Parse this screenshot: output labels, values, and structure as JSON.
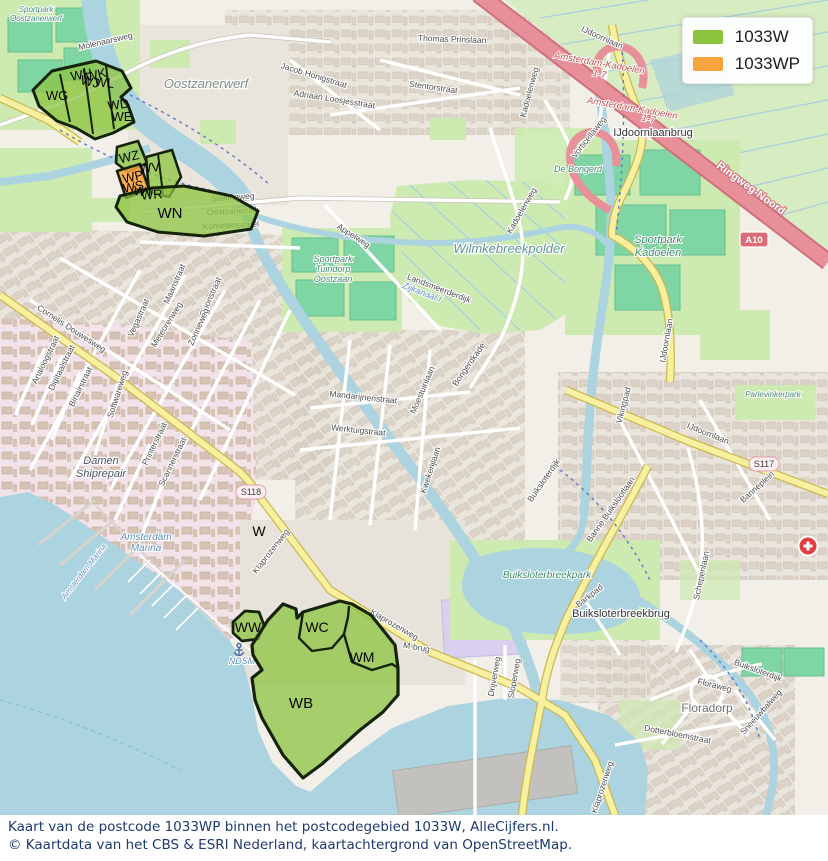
{
  "legend": {
    "items": [
      {
        "label": "1033W",
        "color": "#8cc440"
      },
      {
        "label": "1033WP",
        "color": "#f8a33c"
      }
    ]
  },
  "caption": {
    "line1": "Kaart van de postcode 1033WP binnen het postcodegebied 1033W, AlleCijfers.nl.",
    "line2": "© Kaartdata van het CBS & ESRI Nederland, kaartachtergrond van OpenStreetMap."
  },
  "colors": {
    "overlay_green": "#8cc440",
    "overlay_orange": "#f8a33c",
    "water": "#abd3e0",
    "motorway": "#e8909a",
    "road_yellow": "#f6f0a0"
  },
  "map": {
    "region_labels": [
      "WG",
      "WH",
      "WJ",
      "WK",
      "WL",
      "WD",
      "WE",
      "WZ",
      "WP",
      "WV",
      "WS",
      "WT",
      "WR",
      "WN",
      "W",
      "WW",
      "WC",
      "WM",
      "WB"
    ],
    "street_labels": [
      "Molenaarsweg",
      "Thomas Prinslaan",
      "Stentorstraat",
      "Adriaan Loosjesstraat",
      "Jacob Honigstraat",
      "Stellingweg",
      "Oostzanerdijk",
      "Kometensingel",
      "Appelweg",
      "Meteorenweg",
      "Cornelis Douwesweg",
      "Vegastraat",
      "Maanstraat",
      "Orionstraat",
      "Zonneweg",
      "Mandarijnenstraat",
      "Werktuigstraat",
      "Analoogstraat",
      "Digitaalstraat",
      "Binairstraat",
      "Softwareweg",
      "Printerstraat",
      "Scannerstraat",
      "Klaprozenweg",
      "Klaprozenweg",
      "Klaprozenweg",
      "Kadoelenweg",
      "Kadoelenweg",
      "Vorticellaweg",
      "IJdoornlaan",
      "IJdoornlaan",
      "IJdoornlaan",
      "Landsmeerderdijk",
      "Buiksloterdijk",
      "Buiksloterdijk",
      "Banne Buikslootlaan",
      "Schepenlaan",
      "Banneplein",
      "Floraweg",
      "Dotterbloemstraat",
      "Sneeuwbalweg",
      "Drijverweg",
      "Sloperweg",
      "Bongerdkade",
      "Moestuinlaan",
      "Kwekerijlaan",
      "Vikingpad",
      "M-brug",
      "Barkpad"
    ],
    "area_labels": [
      "Sportpark",
      "Oostzanerwerf",
      "Oostzanerwerf",
      "Wilmkebreekpolder",
      "Sportpark",
      "Tuindorp",
      "Oostzaan",
      "Sportpark",
      "Kadoelen",
      "De Bongerd",
      "Buiksloterbreekpark",
      "Parlevinkerpark",
      "Floradorp",
      "Damen",
      "Shiprepair",
      "IJdoornlaanbrug",
      "Buiksloterbreekbrug",
      "Amsterdam-Kadoelen",
      "1-7",
      "Amsterdam-Kadoelen",
      "1-7",
      "Ringweg-Noord",
      "Amsterdam",
      "Marina",
      "Amsterdam Marina",
      "NDSM",
      "Zijkanaal I"
    ],
    "road_refs": [
      "A10",
      "S117",
      "S118"
    ]
  }
}
